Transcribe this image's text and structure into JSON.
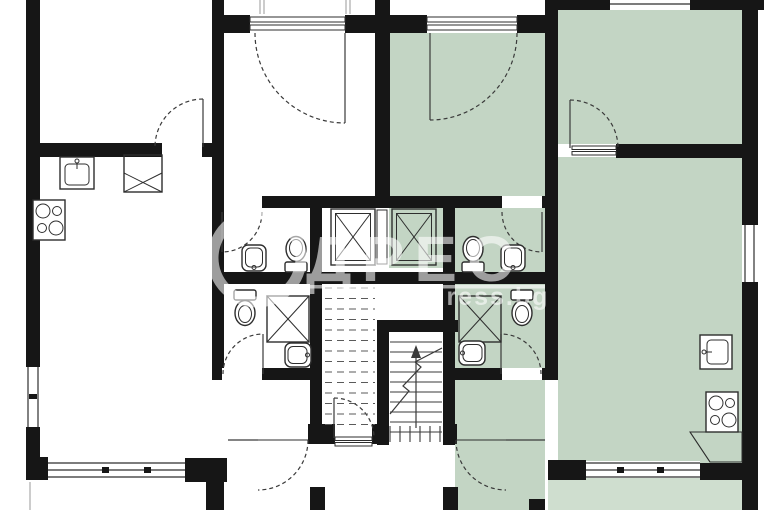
{
  "watermark": {
    "brand": "АДРЕС",
    "logo_text": "ДРЕС",
    "domain_text": "address.bg"
  },
  "colors": {
    "background": "#ffffff",
    "wall": "#161616",
    "room_highlight": "#c3d5c4",
    "balcony_highlight": "#cfdecf",
    "fixture_stroke": "#2e2e2e",
    "dash_line": "#5a5a5a",
    "watermark_fill": "rgba(255,255,255,0.58)"
  },
  "plan": {
    "type": "apartment-floor-plan",
    "highlighted_unit": "right-apartment",
    "units": [
      {
        "id": "left-apartment",
        "highlighted": false,
        "rooms": [
          "living-room-kitchen",
          "bedroom",
          "bathroom",
          "wc",
          "hallway",
          "balcony"
        ]
      },
      {
        "id": "right-apartment",
        "highlighted": true,
        "rooms": [
          "bedroom",
          "bedroom-2",
          "living-room-kitchen",
          "bathroom",
          "wc",
          "hallway",
          "balcony"
        ]
      }
    ],
    "common_areas": [
      "stairwell",
      "elevator-shafts",
      "entrance-vestibule"
    ],
    "fixtures_legend": [
      "kitchen-sink",
      "stove",
      "counter",
      "wash-basin",
      "toilet",
      "shower-cabin",
      "elevator",
      "stairs",
      "door-swing",
      "window"
    ]
  }
}
